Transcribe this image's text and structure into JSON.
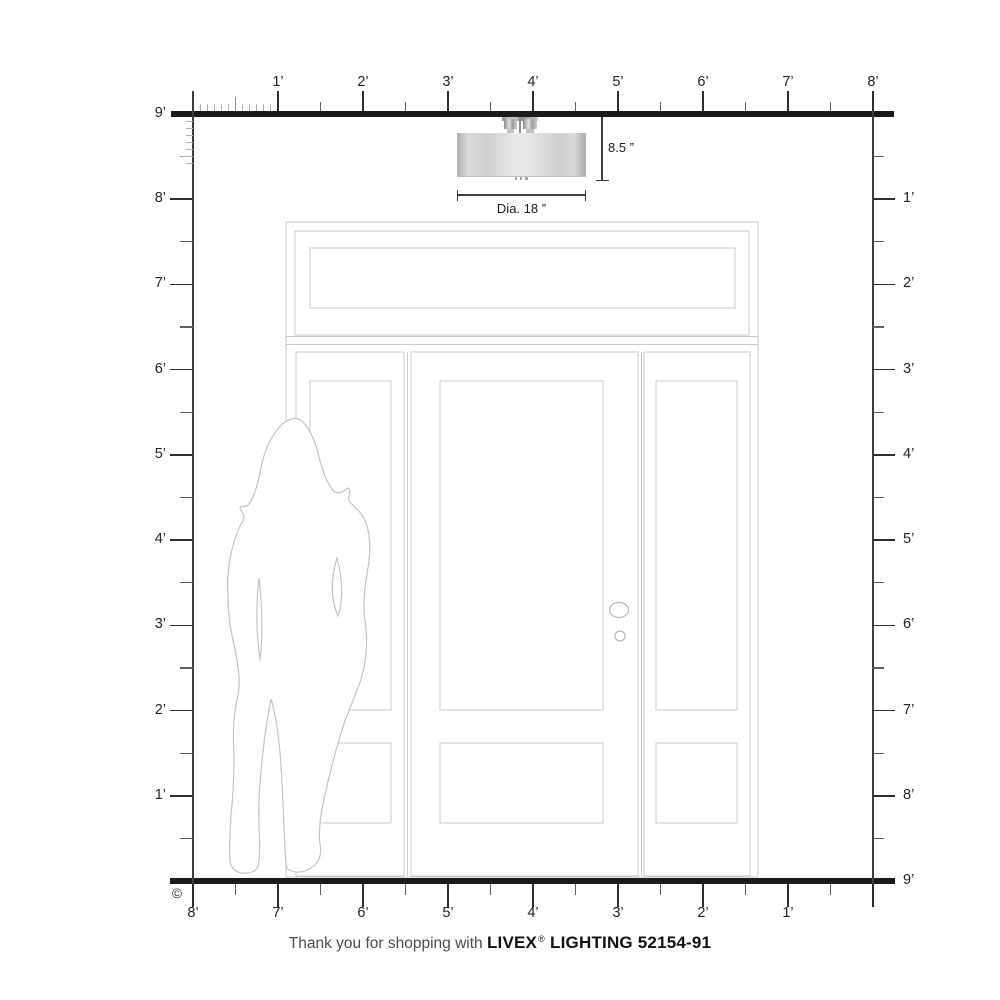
{
  "footer": {
    "thanks": "Thank you for shopping with",
    "brand": "LIVEX",
    "registered": "®",
    "product": "LIGHTING 52154-91"
  },
  "copyright": "©",
  "fixture": {
    "height_label": "8.5 ”",
    "diameter_label": "Dia. 18 ”"
  },
  "rulers": {
    "top_labels": [
      "1’",
      "2’",
      "3’",
      "4’",
      "5’",
      "6’",
      "7’",
      "8’"
    ],
    "left_labels": [
      "9’",
      "8’",
      "7’",
      "6’",
      "5’",
      "4’",
      "3’",
      "2’",
      "1’"
    ],
    "right_labels": [
      "1’",
      "2’",
      "3’",
      "4’",
      "5’",
      "6’",
      "7’",
      "8’",
      "9’"
    ],
    "bottom_labels": [
      "8’",
      "7’",
      "6’",
      "5’",
      "4’",
      "3’",
      "2’",
      "1’"
    ]
  },
  "colors": {
    "axis": "#2e2e2e",
    "half_tick": "#5f5f5f",
    "inch_tick": "#b2b2b2",
    "door_line": "#cbcbcb",
    "silhouette_line": "#c4c4c4",
    "bar": "#1b1b1b"
  }
}
